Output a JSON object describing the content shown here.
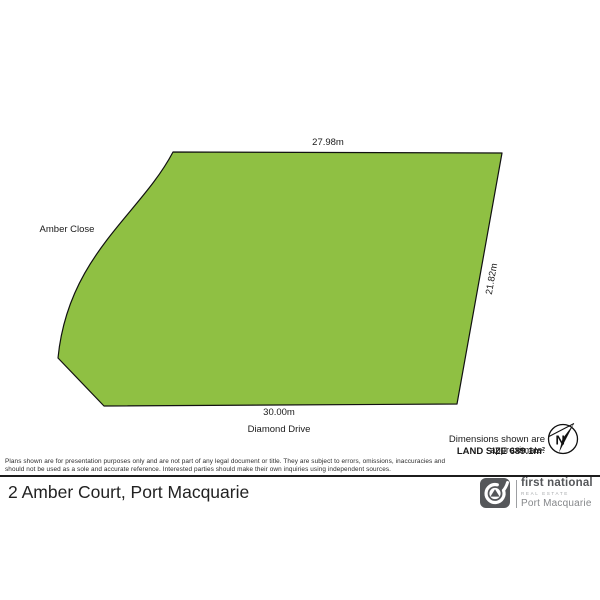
{
  "colors": {
    "parcel_fill": "#8fc043",
    "parcel_stroke": "#111111",
    "logo_gray": "#55575a",
    "rule_dark": "#1c1c1c"
  },
  "plot": {
    "top_dimension": "27.98m",
    "right_dimension": "21.82m",
    "bottom_dimension": "30.00m",
    "street_left": "Amber Close",
    "street_bottom": "Diamond Drive"
  },
  "notes": {
    "approx": "Dimensions shown are approximate.",
    "land_size": "LAND SIZE 689.1m²"
  },
  "compass": {
    "north_label": "N"
  },
  "disclaimer": {
    "line1": "Plans shown are for presentation purposes only and are not part of any legal document or title. They are subject to errors, omissions, inaccuracies and",
    "line2": "should not be used as a sole and accurate reference. Interested parties should make their own inquiries using independent sources."
  },
  "footer": {
    "address": "2 Amber Court, Port Macquarie",
    "brand": {
      "name": "first national",
      "tagline": "REAL ESTATE",
      "office": "Port Macquarie"
    }
  }
}
